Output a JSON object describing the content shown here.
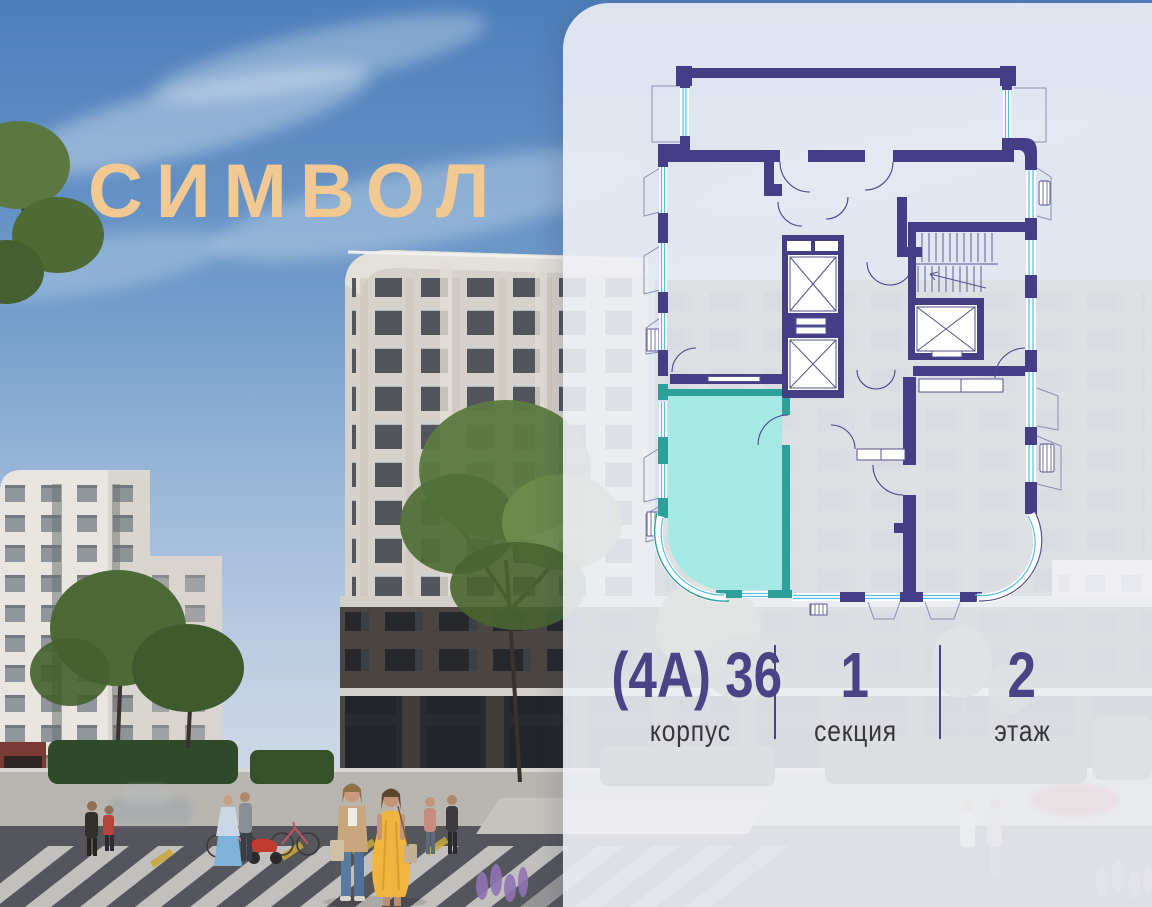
{
  "theme": {
    "accent": "#4A4487",
    "label": "#36363B",
    "logo_gold": "#F2C992",
    "wall": "#453E87",
    "window": "#56BDE8",
    "teal_fill": "#A6E8E3",
    "teal_wall": "#2DA09C"
  },
  "branding": {
    "logo_text": "СИМВОЛ"
  },
  "apartment_info": {
    "building": {
      "value": "(4А) 36",
      "label": "корпус"
    },
    "section": {
      "value": "1",
      "label": "секция"
    },
    "floor": {
      "value": "2",
      "label": "этаж"
    }
  }
}
